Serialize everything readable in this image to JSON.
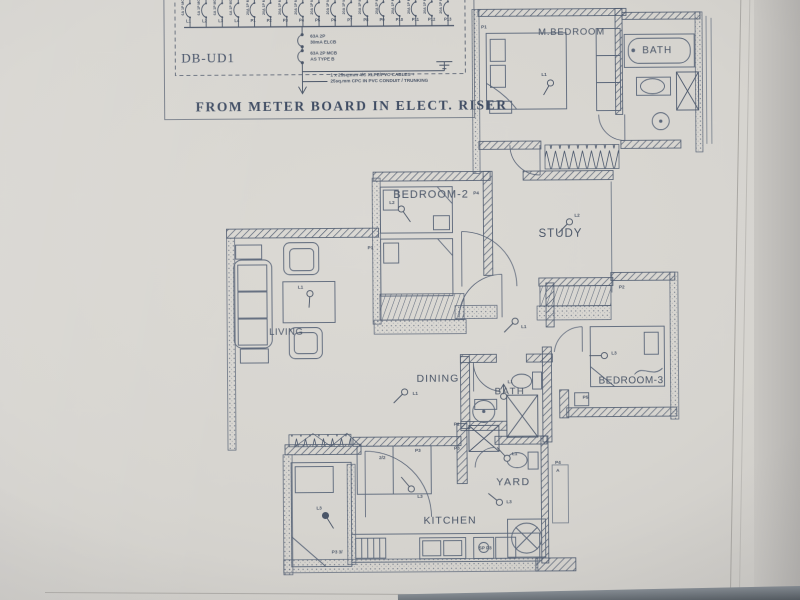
{
  "db": {
    "name": "DB-UD1",
    "caption": "FROM METER BOARD IN ELECT. RISER",
    "elcb_line1": "63A 2P",
    "elcb_line2": "30mA ELCB",
    "mcb_line1": "63A 2P MCB",
    "mcb_line2": "AS TYPE B",
    "cable_note_line1": "1 x 25sq.mm 4/C XLPE/PVC CABLES +",
    "cable_note_line2": "25sq.mm CPC IN PVC CONDUIT / TRUNKING",
    "circuits": [
      "L1",
      "L2",
      "L3",
      "L4",
      "P1",
      "P2",
      "P3",
      "P4",
      "P5",
      "P6",
      "P7",
      "P8",
      "P9",
      "P10",
      "P11",
      "P12",
      "P13"
    ],
    "ratings": [
      "6A 1P MCB",
      "6A 1P MCB",
      "6A 1P MCB",
      "6A 1P MCB",
      "20A 1P MCB",
      "20A 1P MCB",
      "20A 1P MCB",
      "20A 1P MCB",
      "20A 1P MCB",
      "20A 1P MCB",
      "20A 1P MCB",
      "20A 1P MCB",
      "20A 1P MCB",
      "20A 1P MCB",
      "20A 1P MCB",
      "20A 1P MCB",
      "20A 1P MCB"
    ]
  },
  "rooms": {
    "m_bedroom": "M.BEDROOM",
    "bath1": "BATH",
    "bedroom2": "BEDROOM-2",
    "study": "STUDY",
    "living": "LIVING",
    "dining": "DINING",
    "bath2": "BATH",
    "bedroom3": "BEDROOM-3",
    "kitchen": "KITCHEN",
    "yard": "YARD"
  },
  "lights": [
    {
      "label": "L1",
      "cx": 558,
      "cy": 88,
      "tx": 551,
      "ty": 100,
      "lx": 549,
      "ly": 78
    },
    {
      "label": "L2",
      "cx": 408,
      "cy": 213,
      "tx": 417,
      "ty": 226,
      "lx": 396,
      "ly": 205
    },
    {
      "label": "L2",
      "cx": 576,
      "cy": 227,
      "tx": 565,
      "ty": 238,
      "lx": 581,
      "ly": 219
    },
    {
      "label": "L1",
      "cx": 316,
      "cy": 297,
      "tx": 315,
      "ty": 311,
      "lx": 304,
      "ly": 289
    },
    {
      "label": "L1",
      "cx": 521,
      "cy": 326,
      "tx": 510,
      "ty": 337,
      "lx": 527,
      "ly": 330
    },
    {
      "label": "L1",
      "cx": 410,
      "cy": 396,
      "tx": 399,
      "ty": 407,
      "lx": 418,
      "ly": 396
    },
    {
      "label": "L1",
      "cx": 509,
      "cy": 401,
      "tx": 509,
      "ty": 389,
      "lx": 513,
      "ly": 385,
      "arrow": true
    },
    {
      "label": "L3",
      "cx": 610,
      "cy": 361,
      "tx": 595,
      "ty": 361,
      "lx": 617,
      "ly": 357
    },
    {
      "label": "L3",
      "cx": 416,
      "cy": 493,
      "tx": 406,
      "ty": 481,
      "lx": 422,
      "ly": 499
    },
    {
      "label": "L1",
      "cx": 512,
      "cy": 463,
      "tx": 502,
      "ty": 452,
      "lx": 517,
      "ly": 457
    },
    {
      "label": "L3",
      "cx": 504,
      "cy": 507,
      "tx": 493,
      "ty": 498,
      "lx": 511,
      "ly": 505
    },
    {
      "label": "L3",
      "cx": 330,
      "cy": 519,
      "tx": 338,
      "ty": 532,
      "lx": 321,
      "ly": 510,
      "filled": true
    }
  ],
  "sockets": [
    {
      "label": "P1",
      "x": 489,
      "y": 30
    },
    {
      "label": "P1",
      "x": 374,
      "y": 250
    },
    {
      "label": "P4",
      "x": 480,
      "y": 196
    },
    {
      "label": "P2",
      "x": 625,
      "y": 291
    },
    {
      "label": "P5",
      "x": 588,
      "y": 401
    },
    {
      "label": "P1",
      "x": 459,
      "y": 427
    },
    {
      "label": "P3",
      "x": 420,
      "y": 453
    },
    {
      "label": "P3",
      "x": 459,
      "y": 451
    },
    {
      "label": "2/2",
      "x": 384,
      "y": 460
    },
    {
      "label": "SP P3",
      "x": 483,
      "y": 551
    },
    {
      "label": "P3 3/",
      "x": 336,
      "y": 554
    },
    {
      "label": "P4",
      "x": 560,
      "y": 466
    },
    {
      "label": "A",
      "x": 561,
      "y": 474
    }
  ]
}
